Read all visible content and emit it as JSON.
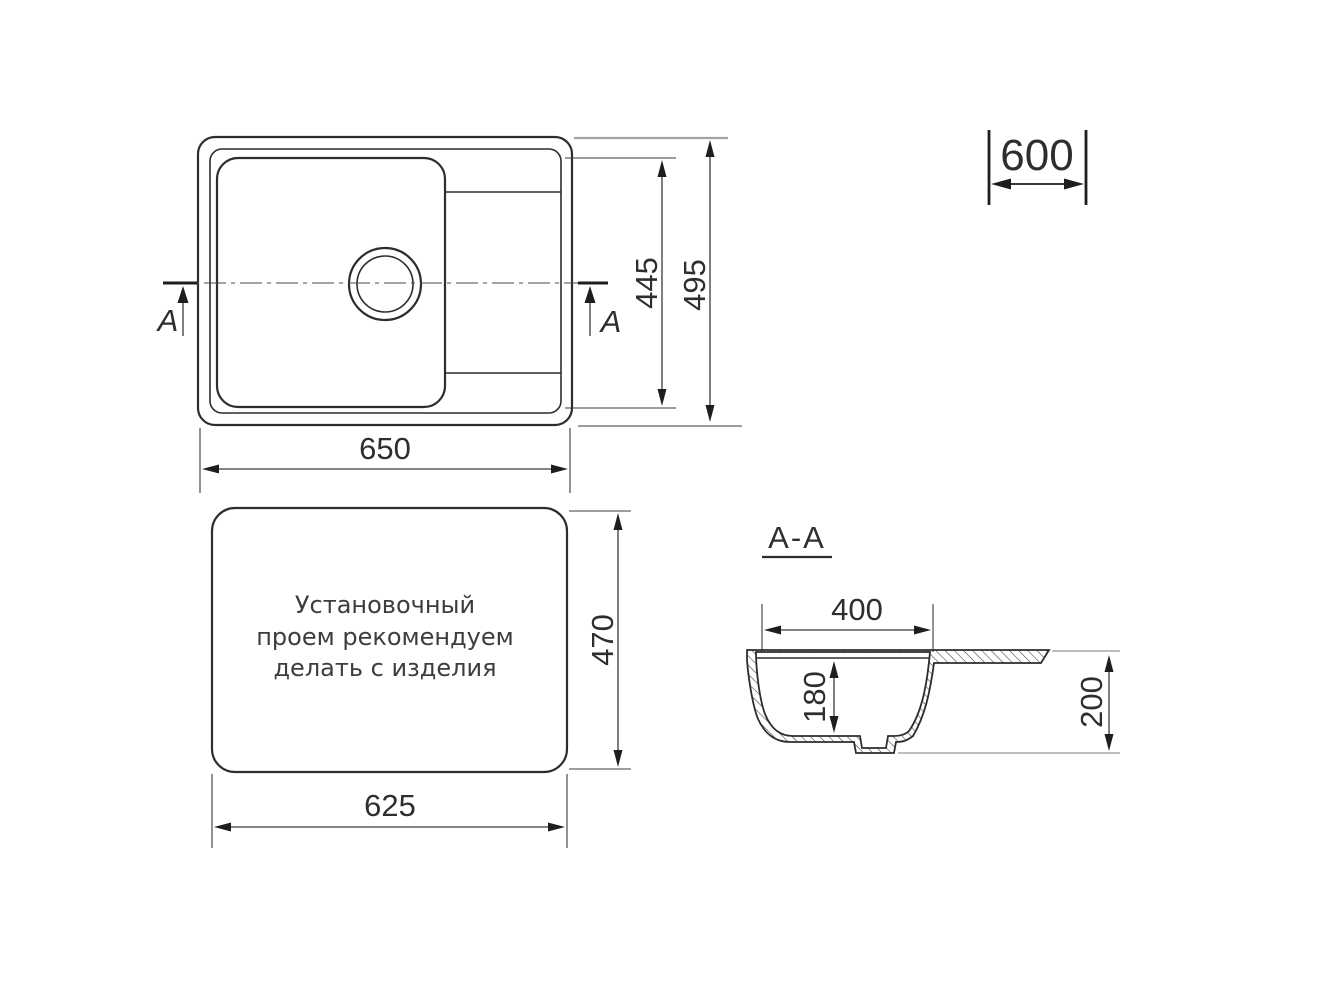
{
  "drawing": {
    "title_hint": "Sink installation drawing",
    "colors": {
      "line": "#2d2d2d",
      "gray_extension": "#a2a2a2",
      "background": "#ffffff"
    },
    "top_view": {
      "section_cut_letter_left": "A",
      "section_cut_letter_right": "A",
      "dim_width": "650",
      "dim_bowl_span_height": "445",
      "dim_overall_height": "495"
    },
    "cabinet_dim": {
      "value": "600"
    },
    "install_view": {
      "note_line1": "Установочный",
      "note_line2": "проем рекомендуем",
      "note_line3": "делать с изделия",
      "dim_width": "625",
      "dim_height": "470"
    },
    "section_view": {
      "title": "A-A",
      "dim_bowl_width": "400",
      "dim_bowl_depth": "180",
      "dim_overall_depth": "200"
    }
  }
}
